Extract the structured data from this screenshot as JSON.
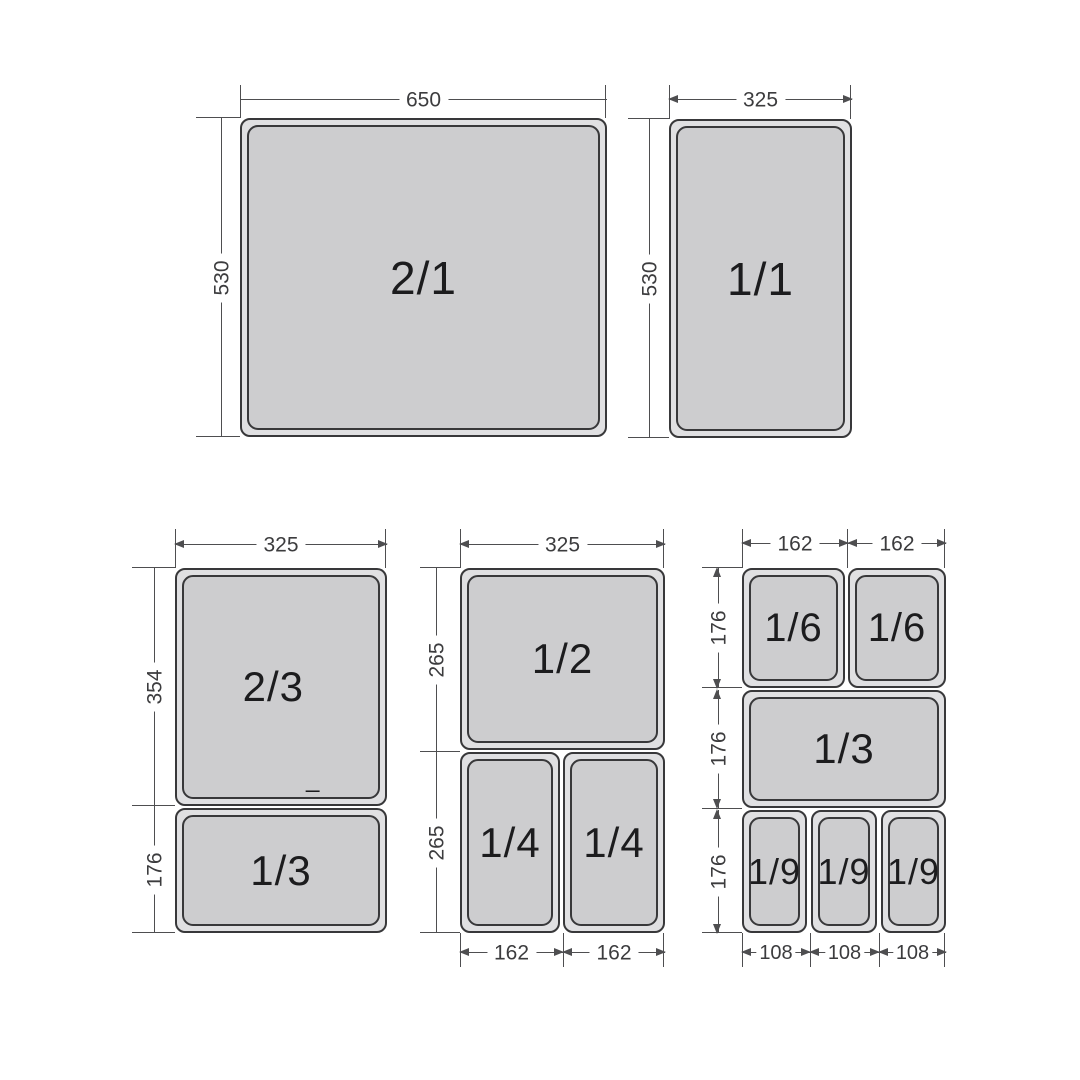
{
  "colors": {
    "background": "#ffffff",
    "pan_fill": "#cdcdcf",
    "pan_rim": "#e0e0e2",
    "pan_border": "#38383a",
    "dim_line": "#4e4e50",
    "dim_text": "#3c3c3e",
    "pan_label": "#1c1c1e"
  },
  "top_left": {
    "pan": "2/1",
    "width": "650",
    "height": "530"
  },
  "top_right": {
    "pan": "1/1",
    "width": "325",
    "height": "530"
  },
  "bottom_left": {
    "width": "325",
    "height_top": "354",
    "height_bottom": "176",
    "pan_top": "2/3",
    "pan_top_mark": "_",
    "pan_bottom": "1/3"
  },
  "bottom_middle": {
    "width": "325",
    "height_top": "265",
    "height_bottom": "265",
    "pan_top": "1/2",
    "pan_bottom_left": "1/4",
    "pan_bottom_right": "1/4",
    "width_bottom_left": "162",
    "width_bottom_right": "162"
  },
  "bottom_right": {
    "widths_top": [
      "162",
      "162"
    ],
    "heights": [
      "176",
      "176",
      "176"
    ],
    "pans_top": [
      "1/6",
      "1/6"
    ],
    "pan_middle": "1/3",
    "pans_bottom": [
      "1/9",
      "1/9",
      "1/9"
    ],
    "widths_bottom": [
      "108",
      "108",
      "108"
    ]
  }
}
